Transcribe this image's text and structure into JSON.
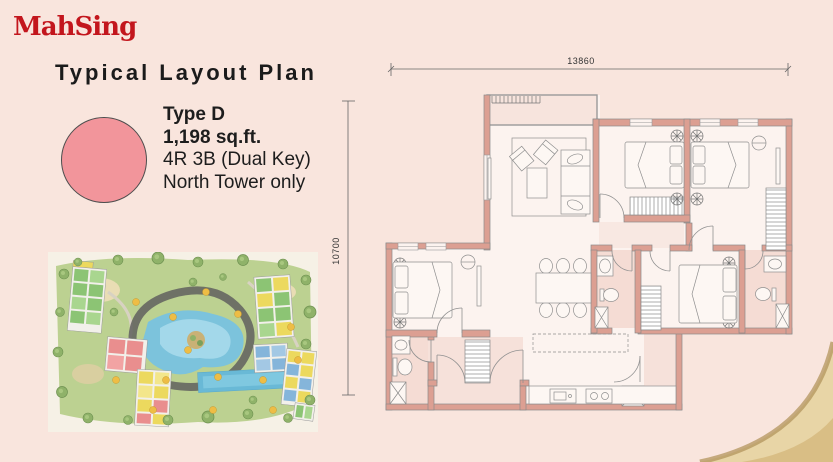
{
  "branding": {
    "logo_text": "MahSing"
  },
  "header": {
    "title": "Typical Layout Plan"
  },
  "unit_legend": {
    "type_label": "Type D",
    "area": "1,198 sq.ft.",
    "layout": "4R 3B (Dual Key)",
    "availability": "North Tower only"
  },
  "floorplan": {
    "dim_width": "13860",
    "dim_height": "10700"
  },
  "colors": {
    "background": "#f9e5dd",
    "logo_red": "#c3161d",
    "accent_marker": "#f2959b",
    "wall_salmon": "#dc9f92",
    "corner_gold": "#e8d5a6"
  }
}
